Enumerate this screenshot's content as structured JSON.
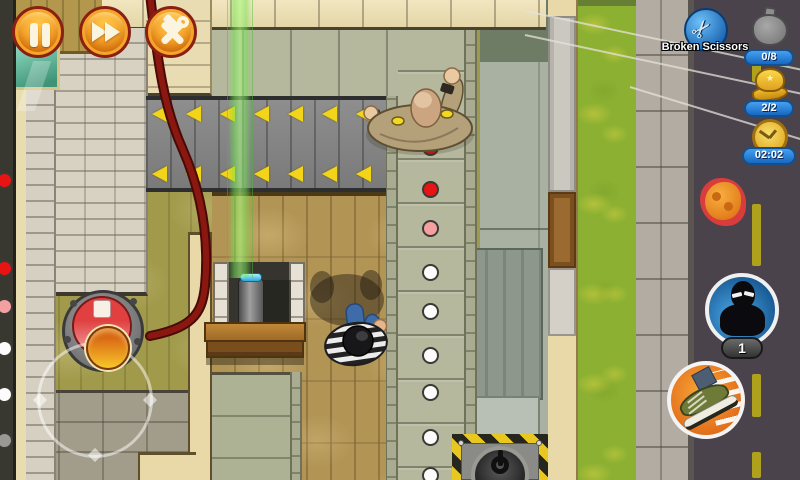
{
  "hud": {
    "controls": {
      "pause_icon": "pause",
      "fast_forward_icon": "fast-forward",
      "tools_icon": "hammer-and-wrench"
    },
    "mission": {
      "name": "Broken Scissors",
      "icon": "scissors"
    },
    "counters": {
      "loot": "0/8",
      "costumes": "2/2",
      "time": "02:02"
    },
    "disguise": {
      "count": "1"
    }
  },
  "scene": {
    "objects": [
      "security-guard",
      "player-robber",
      "conveyor-belt",
      "laser-beam",
      "laser-device",
      "desk",
      "alarm-button",
      "vent-fan",
      "patrol-path",
      "display-case",
      "red-cable"
    ],
    "patrol_dots": [
      {
        "x": 422,
        "y": 139,
        "c": "red"
      },
      {
        "x": 422,
        "y": 181,
        "c": "red"
      },
      {
        "x": 422,
        "y": 220,
        "c": "pink"
      },
      {
        "x": 422,
        "y": 264,
        "c": "white"
      },
      {
        "x": 422,
        "y": 303,
        "c": "white"
      },
      {
        "x": 422,
        "y": 347,
        "c": "white"
      },
      {
        "x": 422,
        "y": 384,
        "c": "white"
      },
      {
        "x": 422,
        "y": 429,
        "c": "white"
      },
      {
        "x": 422,
        "y": 467,
        "c": "white"
      },
      {
        "x": -4,
        "y": 172,
        "c": "red"
      },
      {
        "x": -4,
        "y": 260,
        "c": "red"
      },
      {
        "x": -4,
        "y": 298,
        "c": "pink"
      },
      {
        "x": -4,
        "y": 340,
        "c": "white"
      },
      {
        "x": -4,
        "y": 386,
        "c": "white"
      },
      {
        "x": -4,
        "y": 432,
        "c": "dim"
      }
    ]
  },
  "colors": {
    "hud_button_orange": "#F5A028",
    "hud_button_ring": "#8A2012",
    "counter_pill_blue": "#2F8FE8",
    "mission_icon_blue": "#2C7CC8",
    "laser_green": "#78E464",
    "alert_dot_red": "#E81414",
    "warn_dot_pink": "#F4A0A0",
    "path_dot_white": "#FCFCFC",
    "road_gray": "#4A434C",
    "grass_green": "#8CB032"
  }
}
